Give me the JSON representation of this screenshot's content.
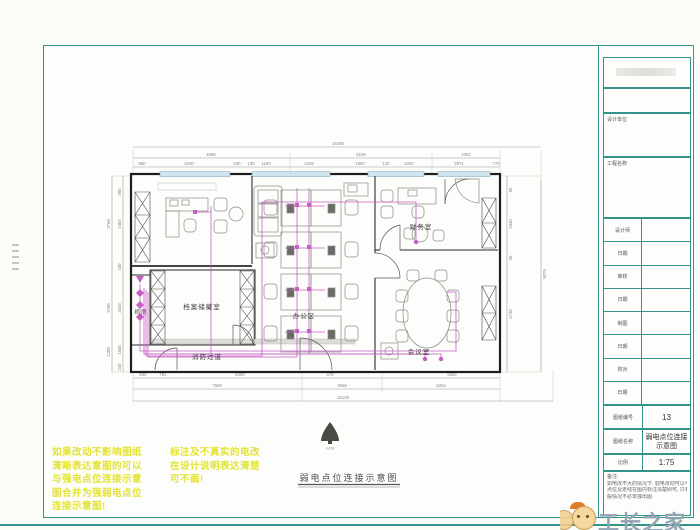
{
  "drawing": {
    "rooms": {
      "archive": "档案储藏室",
      "server": "机房",
      "corridor": "消防过道",
      "office": "办公区",
      "finance": "财务室",
      "meeting": "会议室"
    },
    "caption": "弱电点位连接示意图",
    "north_mark": "APII"
  },
  "dims": {
    "top_total": "16290",
    "top_seg": [
      "4688",
      "5199",
      "2361"
    ],
    "top_sub": [
      "980",
      "3190",
      "930",
      "130",
      "1180",
      "2226",
      "1960",
      "130",
      "2280",
      "2971",
      "770"
    ],
    "bottom_sub": [
      "940",
      "781",
      "8298",
      "478",
      "5584"
    ],
    "bottom_seg": [
      "7569",
      "3568",
      "5254"
    ],
    "bottom_total": "16136",
    "left_inner": [
      "960",
      "2483",
      "180",
      "3428",
      "1500",
      "240"
    ],
    "left_outer": [
      "3766",
      "3785",
      "1200"
    ],
    "right_inner": [
      "90",
      "3340",
      "90",
      "4730"
    ],
    "right_total": "9075"
  },
  "annotations": {
    "left_block": [
      "如果改动不影响图纸",
      "清晰表达意图的可以",
      "与强电点位连接示意",
      "图合并为强弱电点位",
      "连接示意图!"
    ],
    "right_block": [
      "标注及不真实的电改",
      "在设计说明表达清楚",
      "可不画!"
    ]
  },
  "titleblock": {
    "design_unit_label": "设计单位",
    "project_label": "工程名称",
    "rows": [
      {
        "label": "设计师"
      },
      {
        "label": "日期"
      },
      {
        "label": "审核"
      },
      {
        "label": "日期"
      },
      {
        "label": "制图"
      },
      {
        "label": "日期"
      },
      {
        "label": "校对"
      },
      {
        "label": "日期"
      }
    ],
    "sheet_no_label": "图纸编号",
    "sheet_no": "13",
    "sheet_name_label": "图纸名称",
    "sheet_name_1": "弱电点位连接",
    "sheet_name_2": "示意图",
    "scale_label": "比例",
    "scale": "1:75",
    "notes_label": "备注:",
    "notes": [
      "如电改不大的情况下, 弱电改动可以与强电点位图合并表达,",
      "点位及走线在图内标注清楚即可, 只有大改动需另出图的一",
      "般情况不必单独出图."
    ]
  },
  "watermark": {
    "text": "工长之家"
  },
  "colors": {
    "accent_teal": "#35948a",
    "wiring": "#c65ec6",
    "window": "#cfe4ee",
    "annotation_yellow": "#e3e335"
  }
}
